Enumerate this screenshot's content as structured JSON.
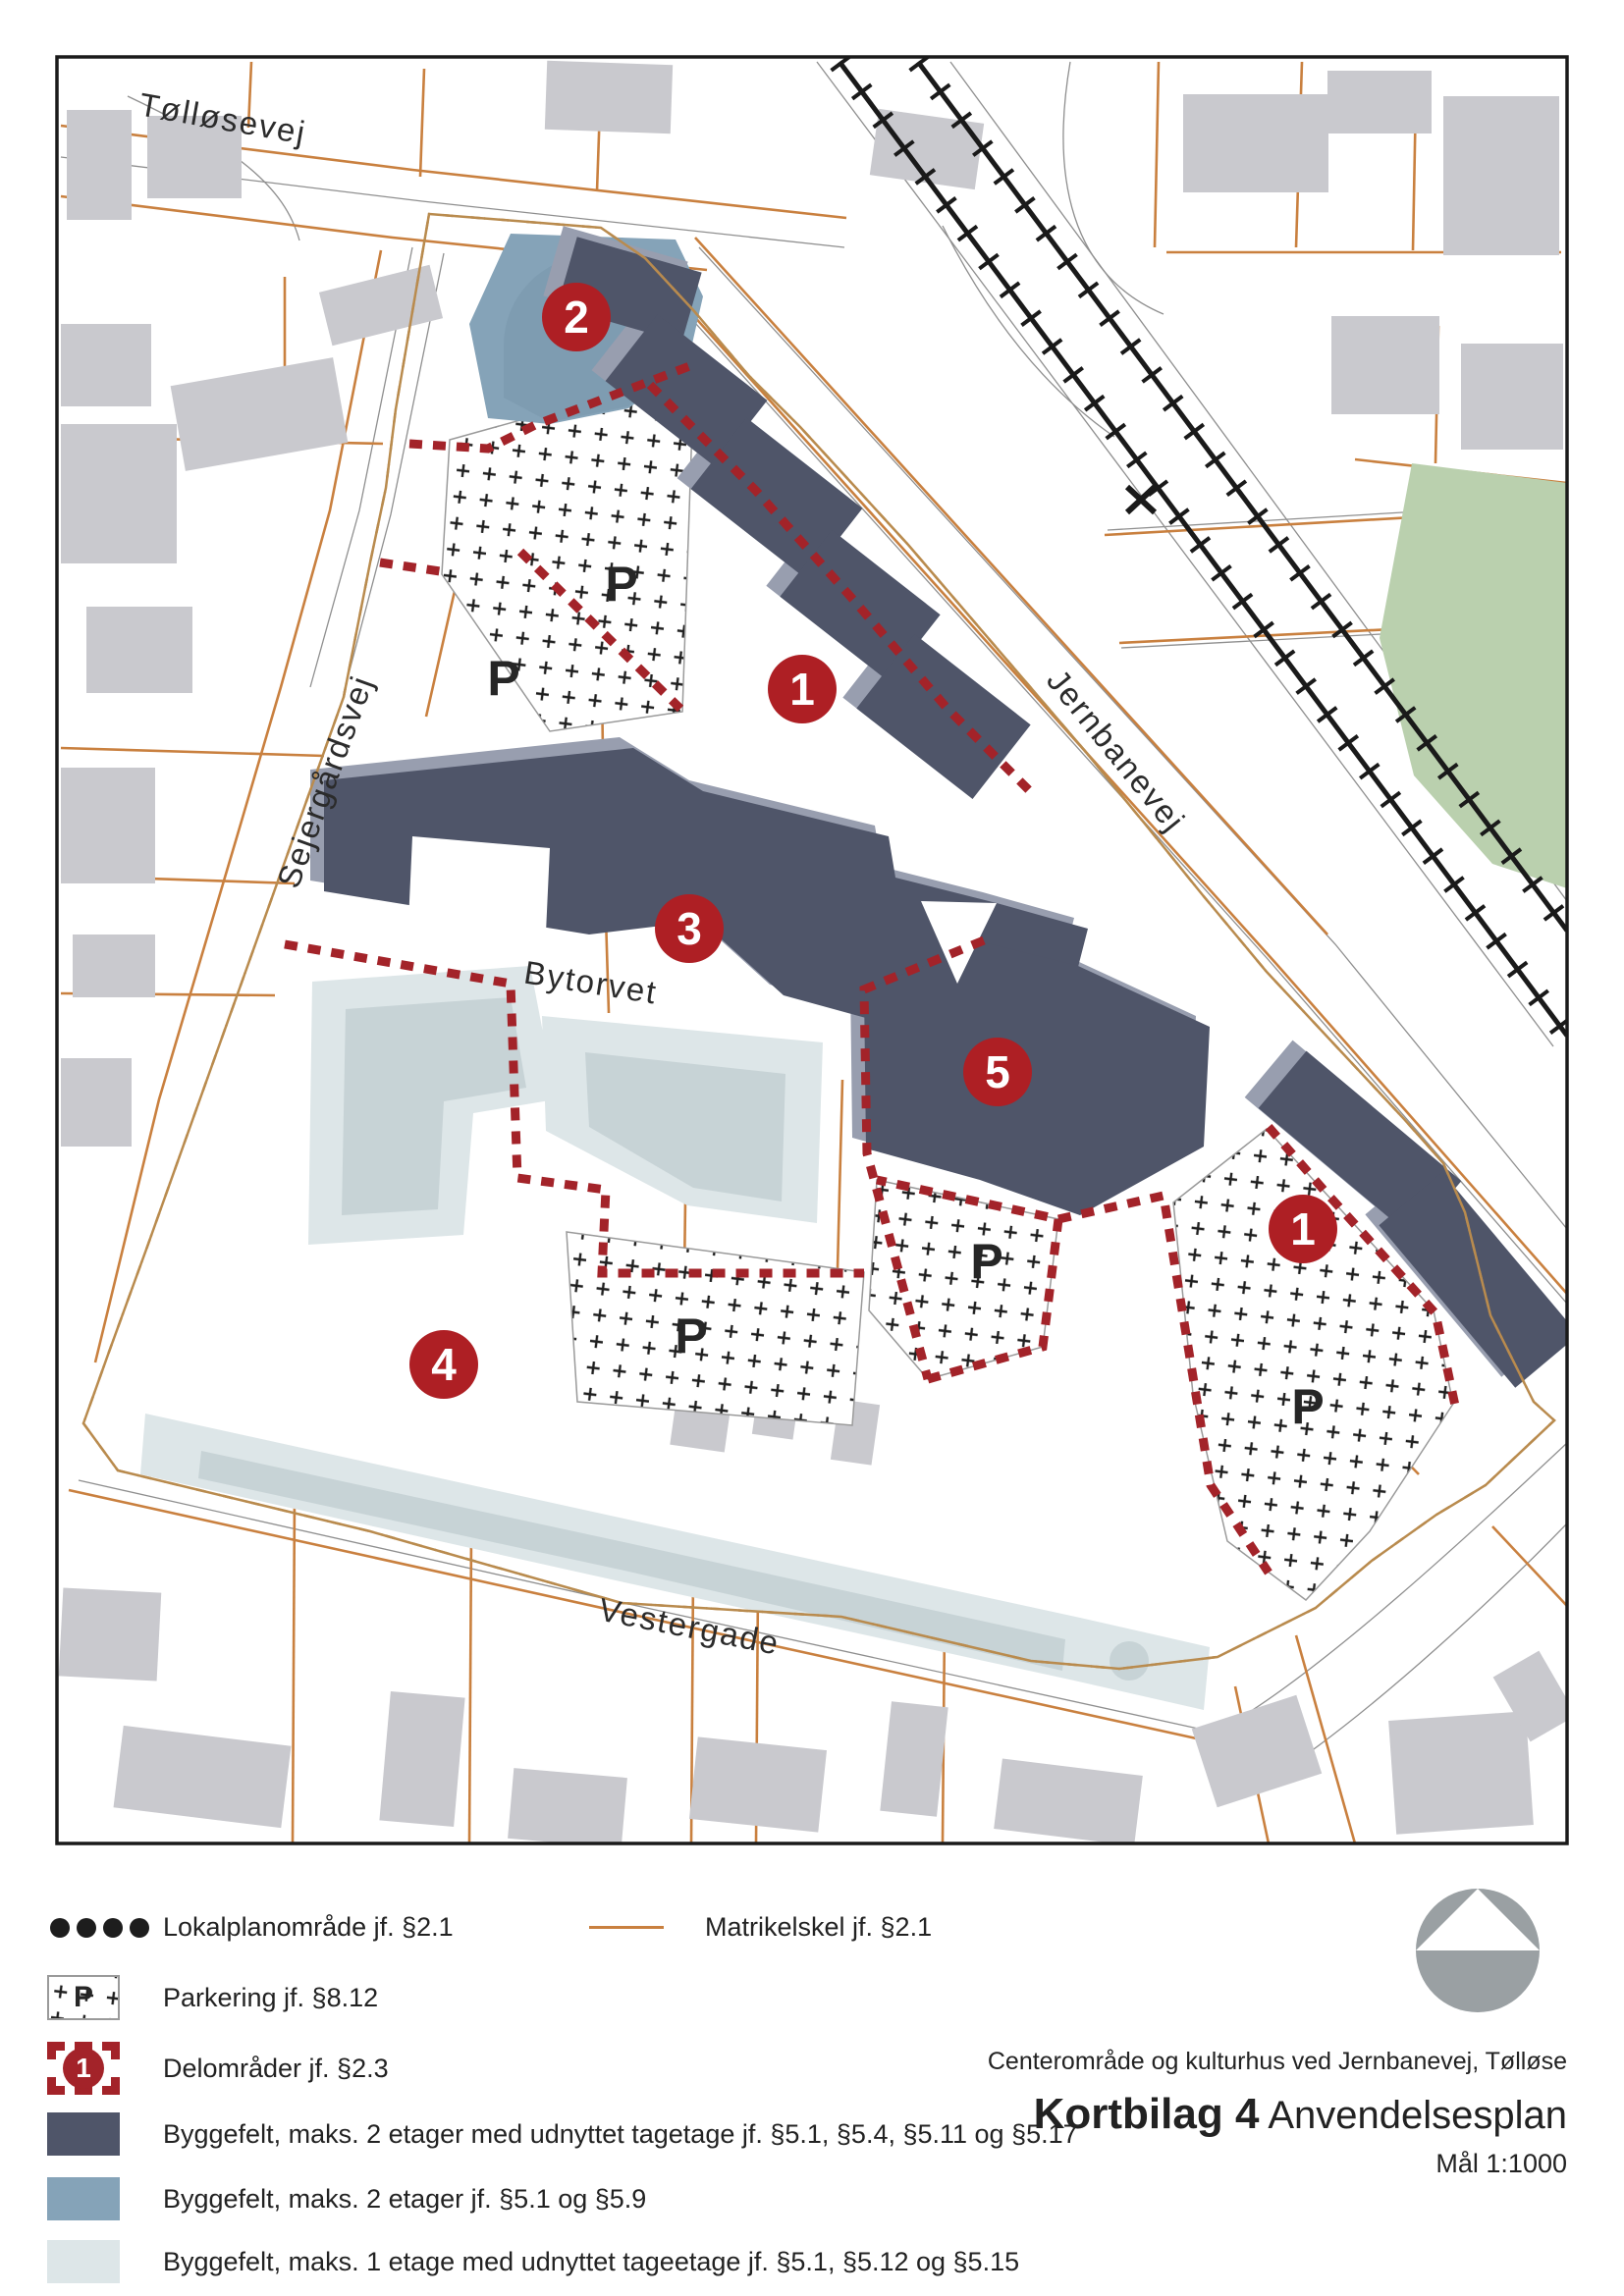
{
  "map": {
    "streets": {
      "tollosevej": "Tølløsevej",
      "sejergardsvej": "Sejergårdsvej",
      "jernbanevej": "Jernbanevej",
      "bytorvet": "Bytorvet",
      "vestergade": "Vestergade"
    },
    "markers": [
      {
        "number": "2"
      },
      {
        "number": "1"
      },
      {
        "number": "3"
      },
      {
        "number": "5"
      },
      {
        "number": "1"
      },
      {
        "number": "4"
      }
    ],
    "parking_label": "P",
    "colors": {
      "delomrade_red": "#a32329",
      "marker_red": "#ae1f24",
      "byggefelt_2_etager_tagetage": "#4f5569",
      "byggefelt_2_etager": "#85a3b8",
      "byggefelt_1_etage": "#dde6e8",
      "matrikel_orange": "#c9803f",
      "context_building_gray": "#c9c9ce",
      "green_area": "#bad0ae",
      "boundary_black": "#1d1d1d"
    }
  },
  "legend": {
    "items": [
      {
        "label": "Lokalplanområde jf. §2.1"
      },
      {
        "label": "Matrikelskel jf. §2.1"
      },
      {
        "label": "Parkering jf. §8.12",
        "swatch_letter": "P"
      },
      {
        "label": "Delområder jf. §2.3",
        "swatch_number": "1"
      },
      {
        "label": "Byggefelt, maks. 2 etager med udnyttet tagetage jf. §5.1, §5.4, §5.11 og §5.17"
      },
      {
        "label": "Byggefelt, maks. 2 etager jf. §5.1 og §5.9"
      },
      {
        "label": "Byggefelt, maks. 1 etage med udnyttet tageetage jf. §5.1, §5.12 og §5.15"
      }
    ]
  },
  "title_block": {
    "project": "Centerområde og kulturhus ved Jernbanevej, Tølløse",
    "sheet": "Kortbilag 4",
    "sheet_type": "Anvendelsesplan",
    "scale": "Mål 1:1000"
  }
}
